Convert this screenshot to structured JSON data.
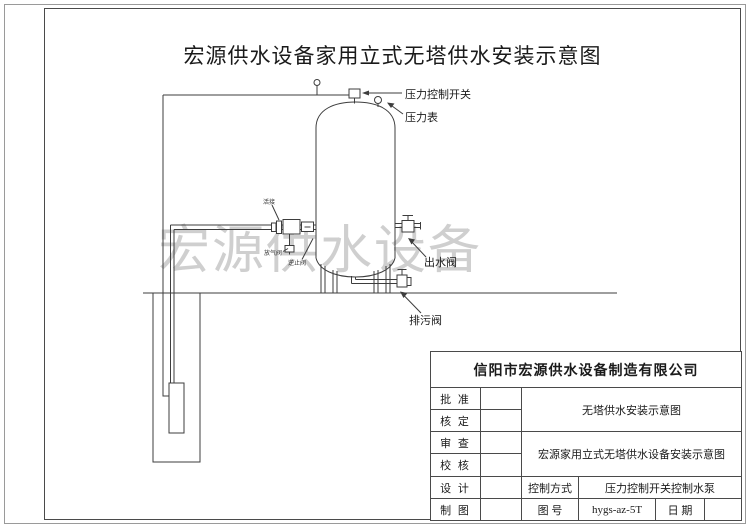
{
  "title": "宏源供水设备家用立式无塔供水安装示意图",
  "watermark": "宏源供水设备",
  "diagram_labels": {
    "pressure_switch": "压力控制开关",
    "pressure_gauge": "压力表",
    "outlet_valve": "出水阀",
    "drain_valve": "排污阀",
    "pipe_union": "活接",
    "air_valve": "放气阀",
    "check_valve": "逆止阀"
  },
  "title_block": {
    "company": "信阳市宏源供水设备制造有限公司",
    "approve_label": "批 准",
    "verify_label": "核 定",
    "review_label": "审 查",
    "proof_label": "校 核",
    "design_label": "设 计",
    "draft_label": "制 图",
    "drawing_name_top": "无塔供水安装示意图",
    "drawing_name_bottom": "宏源家用立式无塔供水设备安装示意图",
    "control_mode_label": "控制方式",
    "control_mode_value": "压力控制开关控制水泵",
    "drawing_no_label": "图 号",
    "drawing_no_value": "hygs-az-5T",
    "date_label": "日 期"
  }
}
